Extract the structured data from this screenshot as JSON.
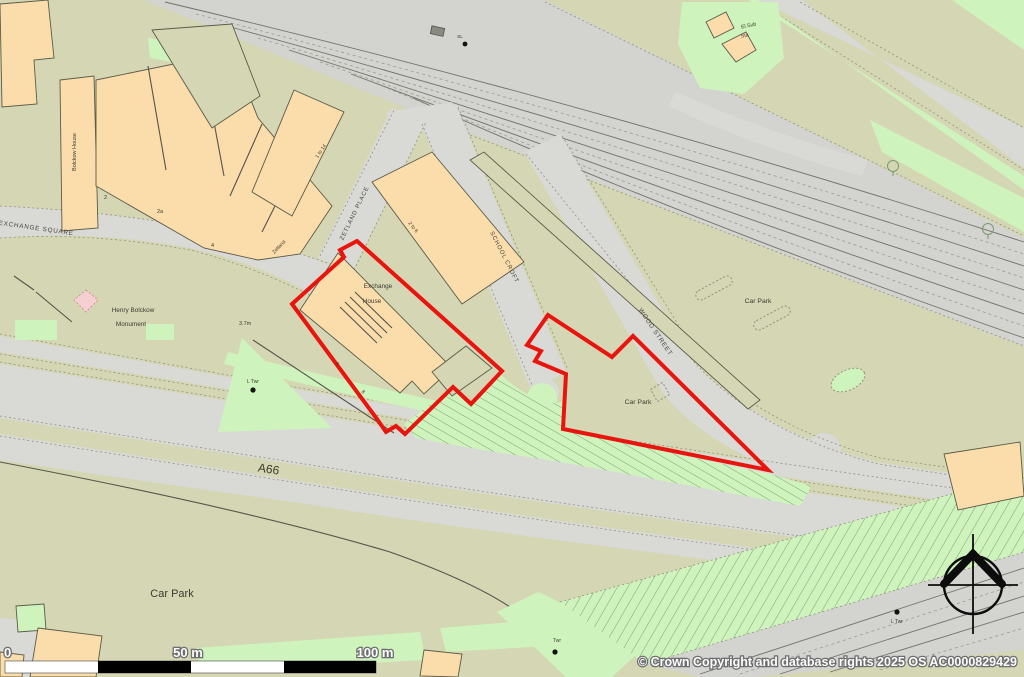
{
  "map": {
    "street_labels": {
      "exchange_square": "EXCHANGE SQUARE",
      "zetland_place": "ZETLAND PLACE",
      "school_croft": "SCHOOL CROFT",
      "wood_street": "WOOD STREET",
      "a66": "A66"
    },
    "place_labels": {
      "bolckow_house": "Bolckow House",
      "exchange_house_line1": "Exchange",
      "exchange_house_line2": "House",
      "monument_line1": "Henry Bolckow",
      "monument_line2": "Monument",
      "car_park_northeast": "Car Park",
      "car_park_site": "Car Park",
      "car_park_southwest": "Car Park",
      "el_sub_sta_line1": "El Sub",
      "el_sub_sta_line2": "Sta"
    },
    "small_labels": {
      "no_2": "2",
      "no_2a": "2a",
      "no_4": "4",
      "no_6": "6",
      "no_8": "8",
      "zetland": "Zetland",
      "one_to_14": "1 to 14",
      "two_to_6": "2 to 6",
      "spot_height": "3.7m",
      "l_twr_west": "L Twr",
      "l_twr_east": "L Twr",
      "twr": "Twr",
      "sl": "SL"
    },
    "scale_bar": {
      "zero": "0",
      "mid": "50 m",
      "end": "100 m"
    },
    "copyright": "© Crown Copyright and database rights 2025 OS AC0000829429",
    "colors": {
      "boundary_red": "#e8140e",
      "building_fill": "#fbdcab",
      "road_fill": "#d9d9d6",
      "land_fill": "#d5d6b4",
      "green_fill": "#cff3bd",
      "rail_fill": "#d3d3d0",
      "monument_pink": "#f5cfd2"
    }
  }
}
